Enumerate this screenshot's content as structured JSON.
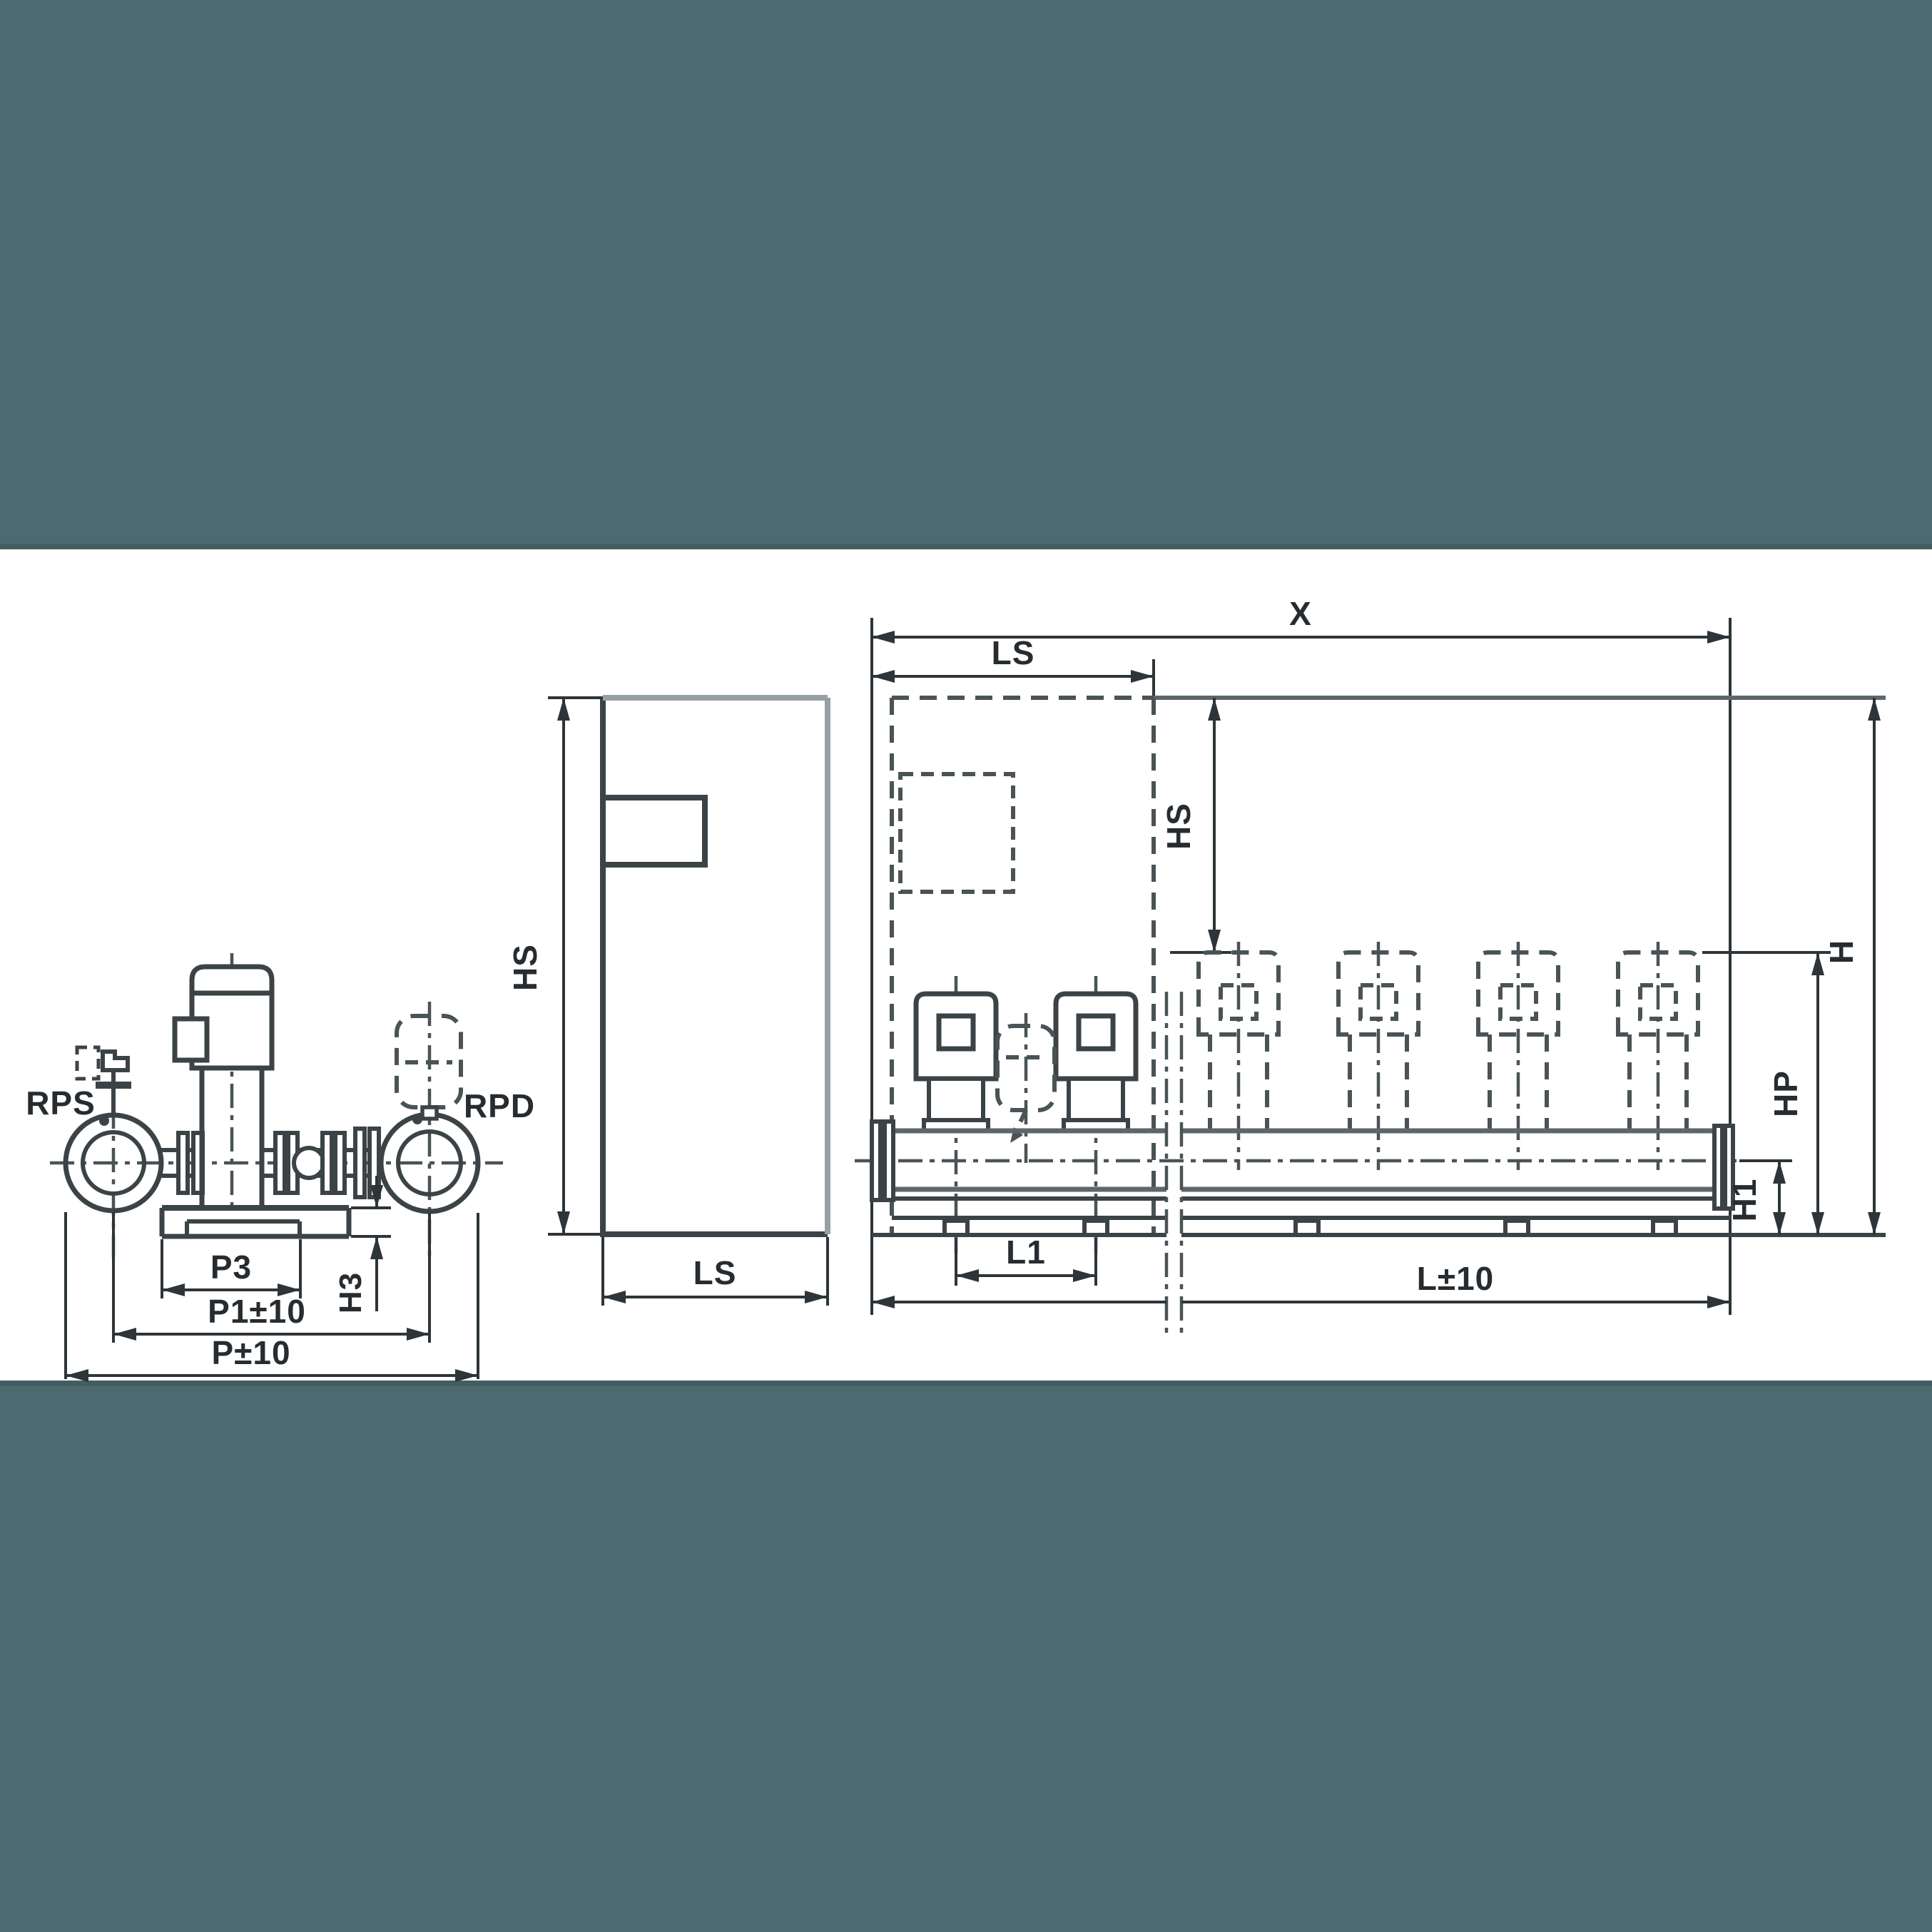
{
  "colors": {
    "band": "#4d6a71",
    "band_edge": "#445d63",
    "paper": "#ffffff",
    "line": "#3c4346",
    "dimension": "#2e3539"
  },
  "front_view": {
    "port_suction": "RPS",
    "port_discharge": "RPD",
    "dim_p3": "P3",
    "dim_p1": "P1±10",
    "dim_p": "P±10",
    "dim_h3": "H3"
  },
  "cabinet_view": {
    "dim_height": "HS",
    "dim_depth": "LS"
  },
  "system_view": {
    "dim_x": "X",
    "dim_ls": "LS",
    "dim_hs": "HS",
    "dim_h": "H",
    "dim_hp": "HP",
    "dim_h1": "H1",
    "dim_l1": "L1",
    "dim_l": "L±10"
  }
}
